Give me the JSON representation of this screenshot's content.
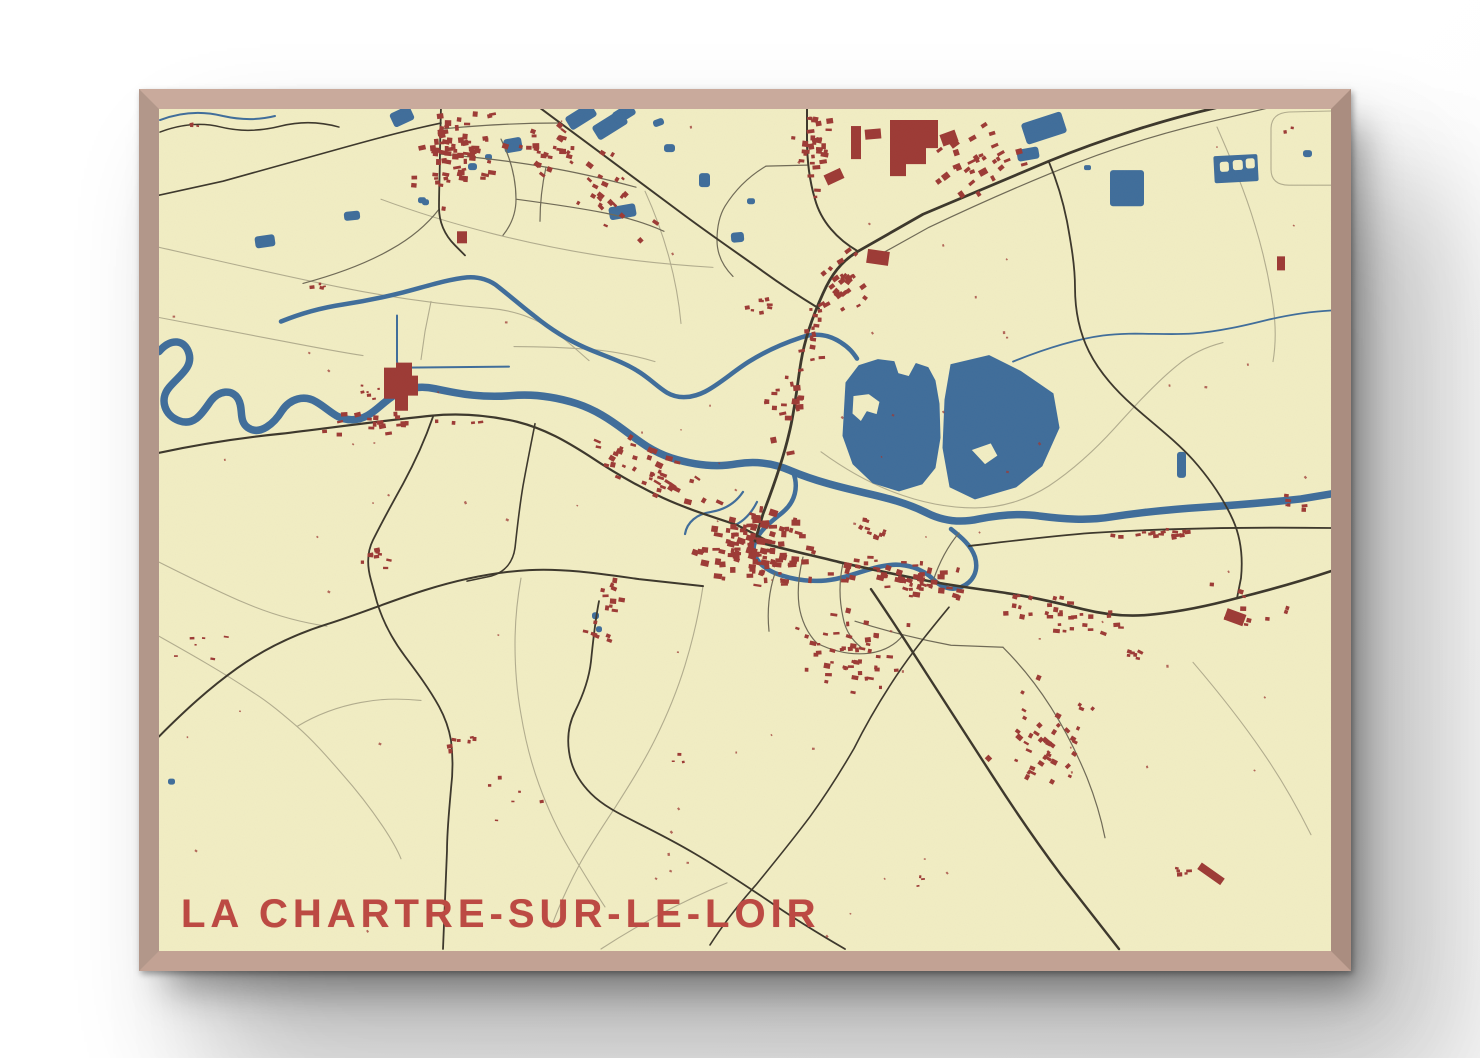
{
  "poster": {
    "title": "LA CHARTRE-SUR-LE-LOIR",
    "type_label": "framed-map-poster"
  },
  "colors": {
    "paper": "#f2eec5",
    "water": "#3f6d9c",
    "water_town": "#4a78a8",
    "building": "#9d3a36",
    "road_major": "#3c372c",
    "road_minor": "#6f6a57",
    "field_line": "#b2ad8f",
    "title_red": "#bc4a43",
    "frame_wood": "#b9998b",
    "wall": "#ffffff"
  },
  "map": {
    "lakes": [
      "M845,383 L858,366 L877,360 L893,362 L897,374 L908,377 L915,364 L927,368 L934,381 L938,404 L939,438 L934,468 L921,484 L898,491 L872,483 L852,464 L842,436 Z M852,396 L868,394 L879,402 L876,415 L866,412 L860,422 L851,414 Z",
      "M950,365 L988,356 L1020,372 L1052,394 L1058,428 L1041,466 L1015,487 L974,499 L949,487 L942,448 L944,400 Z M970,450 L990,443 L997,456 L984,465 Z"
    ],
    "rivers": [
      {
        "w": 7.5,
        "d": "M158,352 C170,338 184,340 188,354 C192,368 178,376 168,388 C158,400 164,416 178,421 C194,427 202,412 210,401 C218,391 231,389 237,399 C243,409 237,421 247,428 C259,436 273,424 281,411 C289,399 303,395 315,402 C329,410 335,420 351,420 C369,420 378,405 394,395 C406,388 420,386 434,389 C462,395 482,398 510,396 C532,394 554,397 576,404 C594,410 608,419 624,431 C640,443 652,452 670,458 C692,465 714,468 736,464 C754,461 772,463 790,471 C814,481 838,487 864,493 C886,498 906,503 926,513 C942,521 960,523 978,519 C998,515 1018,513 1038,516 C1062,519 1086,521 1110,517 C1142,512 1174,509 1206,507 C1240,505 1272,502 1300,499 L1330,494"
      },
      {
        "w": 4.5,
        "d": "M280,322 C302,313 322,308 342,305 C362,302 382,298 402,293 C422,288 446,280 466,278 C478,277 490,281 498,288 C512,299 522,308 534,317 C550,330 566,340 584,348 C602,356 620,361 636,371 C648,378 656,387 666,393 C678,400 692,398 704,392 C718,385 732,372 748,362 C764,352 782,344 800,338 C814,333 828,335 840,343 C848,348 852,353 856,359"
      },
      {
        "w": 4.5,
        "d": "M792,472 C798,487 794,502 782,512 C770,522 757,531 753,545 C751,557 760,567 774,573 C792,580 814,583 834,579 C854,575 870,567 888,565 C906,563 922,569 932,579 C940,587 950,591 960,587 C972,582 978,571 974,557 C970,545 960,537 950,529"
      },
      {
        "w": 2,
        "d": "M396,316 L396,361 Q396,368 404,368 L508,367"
      },
      {
        "w": 2.2,
        "d": "M742,492 C734,504 722,510 710,512 C696,514 686,522 684,534"
      },
      {
        "w": 2.2,
        "d": "M756,502 C750,514 742,522 732,526"
      },
      {
        "w": 1.8,
        "d": "M1012,362 C1042,350 1072,340 1102,336 C1132,332 1162,336 1192,334 C1218,332 1244,326 1268,320 C1290,315 1310,312 1330,311"
      },
      {
        "w": 2,
        "d": "M159,121 C180,113 202,112 222,117 C240,121 258,121 274,117"
      }
    ],
    "roads_major": [
      {
        "w": 2.8,
        "d": "M1296,90 L1214,109 C1162,121 1102,140 1048,162 C1002,181 962,198 922,215 L857,252 C840,262 830,276 822,294 C812,316 804,338 800,362 C796,386 794,410 788,434 C782,460 772,488 762,514 L754,541"
      },
      {
        "w": 2,
        "d": "M527,100 C577,137 628,175 678,212 C706,233 734,252 762,272 C780,285 800,298 818,309"
      },
      {
        "w": 2.2,
        "d": "M158,453 C200,444 240,438 280,434 C330,428 380,421 430,416 C460,413 490,416 516,422 C544,429 566,442 588,456 C612,472 636,486 662,498 C686,509 712,517 736,525 L763,539"
      },
      {
        "w": 2.6,
        "d": "M754,541 C782,549 810,555 838,562 C868,569 898,575 928,581 C954,586 980,589 1006,593 C1032,597 1058,603 1082,609 C1106,615 1130,617 1154,614 C1182,611 1210,605 1236,598 C1268,590 1300,581 1330,571"
      },
      {
        "w": 2.4,
        "d": "M870,589 C890,618 908,646 926,674 C948,708 970,742 992,776 C1014,810 1036,842 1060,874 L1118,948"
      },
      {
        "w": 2,
        "d": "M158,736 C184,710 208,688 236,668 C264,648 294,634 326,624 C358,614 392,600 424,590 C456,580 492,572 528,570 C564,568 602,574 638,579 L702,586"
      },
      {
        "w": 2,
        "d": "M806,95 L806,140 C806,160 808,180 814,200 C820,222 836,240 857,252"
      },
      {
        "w": 1.8,
        "d": "M1048,163 C1056,182 1062,202 1066,222 C1070,244 1074,266 1074,288 C1074,310 1078,332 1088,352 C1098,372 1114,390 1132,406 C1152,424 1174,440 1192,460 C1208,478 1222,498 1232,520 C1240,538 1242,558 1240,578 L1236,598"
      },
      {
        "w": 1.8,
        "d": "M432,417 C424,440 414,462 402,484 C392,502 382,520 372,540 C366,552 366,566 370,580 L376,602 C382,622 392,640 404,656 C416,672 428,688 438,706 C444,717 448,728 450,740 C452,756 452,772 450,788 C448,812 446,830 446,850 L442,948"
      },
      {
        "w": 1.6,
        "d": "M534,424 C530,444 526,464 522,486 C518,510 516,530 514,548 C512,562 504,572 490,576 L466,581"
      },
      {
        "w": 1.8,
        "d": "M598,601 C594,621 592,641 590,661 C588,679 582,695 574,711 C568,723 566,737 568,751 C570,767 578,781 590,793 C602,805 618,813 634,821 C654,831 674,841 694,853 C718,867 742,883 766,899 C792,917 818,933 844,948"
      },
      {
        "w": 1.6,
        "d": "M440,124 C402,132 366,142 330,152 C294,162 258,172 222,182 L158,196"
      },
      {
        "w": 1.8,
        "d": "M440,107 L439,150 C439,170 438,190 438,208 C438,224 444,236 454,246 L464,256"
      },
      {
        "w": 1.8,
        "d": "M968,546 C1010,541 1050,536 1090,533 C1170,528 1250,527 1330,528"
      },
      {
        "w": 1.6,
        "d": "M948,607 C929,630 911,652 895,676 C879,700 865,724 853,748 C839,772 825,794 809,816 C791,840 773,862 755,884 C739,902 723,922 709,944"
      },
      {
        "w": 1.5,
        "d": "M159,133 C180,125 200,123 220,128 C240,133 260,132 280,127 C300,122 320,123 338,128"
      }
    ],
    "roads_minor": [
      {
        "d": "M1284,105 L1212,122 C1152,136 1098,154 1050,174 C1006,192 966,210 928,228 L874,258"
      },
      {
        "d": "M765,167 L806,166"
      },
      {
        "d": "M765,167 C748,177 734,191 724,207 C718,217 716,229 716,241 C716,255 722,267 732,277"
      },
      {
        "d": "M440,130 C480,126 520,124 558,124"
      },
      {
        "d": "M440,155 C475,158 510,162 545,168 C575,173 605,180 635,188"
      },
      {
        "d": "M500,140 C510,160 515,180 515,200 C515,214 510,226 502,236"
      },
      {
        "d": "M515,200 C545,204 575,208 605,214 C625,218 645,224 663,232"
      },
      {
        "d": "M545,168 C541,186 539,204 539,222"
      },
      {
        "d": "M438,210 C424,228 408,240 390,250 C362,266 332,276 302,284"
      },
      {
        "d": "M802,557 C798,573 796,589 798,605 C800,619 806,633 816,643"
      },
      {
        "d": "M842,563 C838,581 838,599 842,617 C844,629 850,639 860,647"
      },
      {
        "d": "M816,643 C832,651 850,655 868,653 C882,651 894,645 902,635"
      },
      {
        "d": "M774,573 C768,591 766,611 768,631"
      },
      {
        "d": "M932,581 C938,563 946,547 958,533"
      },
      {
        "d": "M1002,647 C1020,665 1036,685 1050,707 C1064,729 1076,753 1086,777 C1094,797 1100,817 1104,837"
      },
      {
        "d": "M854,621 C886,631 918,639 950,645 L1002,647"
      }
    ],
    "field_lines": [
      {
        "d": "M158,248 C220,262 280,276 340,288 C390,298 440,305 490,309 C512,311 530,317 546,327 C562,337 574,349 588,361"
      },
      {
        "d": "M430,302 L424,332 L420,360"
      },
      {
        "d": "M820,452 C842,468 866,482 892,492 C918,502 946,508 974,508 C1000,508 1026,500 1048,486 C1072,470 1094,450 1114,428 C1134,406 1154,384 1176,366 C1190,354 1206,347 1222,343"
      },
      {
        "d": "M1330,112 L1288,113 Q1270,114 1270,130 L1270,170 Q1270,186 1288,186 L1330,186"
      },
      {
        "d": "M1216,128 C1230,160 1244,192 1254,226 C1262,252 1268,278 1272,306 C1275,326 1275,344 1272,362"
      },
      {
        "d": "M158,562 C186,576 214,590 242,602 C270,614 298,622 326,626"
      },
      {
        "d": "M158,636 C190,654 222,672 252,692 C268,702 282,714 296,726 C312,740 326,756 340,772 C356,790 370,808 382,826 C390,838 396,848 400,858"
      },
      {
        "d": "M296,726 C316,714 338,706 360,702 C380,698 400,698 420,700"
      },
      {
        "d": "M520,578 C516,600 514,622 514,644 C514,668 516,692 520,714 C524,738 530,762 538,784 C546,806 556,828 568,848 C580,868 592,888 604,906"
      },
      {
        "d": "M702,586 C698,613 692,639 684,665 C676,691 666,715 654,739 C642,763 628,785 614,807 C602,825 590,843 580,861 C568,883 558,905 550,927"
      },
      {
        "d": "M513,347 C540,347 566,348 592,350 C614,352 634,356 654,362"
      },
      {
        "d": "M158,318 C200,326 242,334 284,342 C310,347 336,352 362,356"
      },
      {
        "d": "M600,948 C640,922 682,900 726,882"
      },
      {
        "d": "M644,192 C654,214 662,236 668,258 C674,280 678,302 680,324"
      },
      {
        "d": "M1192,662 C1216,690 1240,720 1262,752 C1280,778 1296,806 1310,834"
      },
      {
        "d": "M380,200 C450,226 530,246 610,258 C646,263 680,266 712,268"
      }
    ],
    "ponds": [
      [
        254,
        236,
        20,
        12,
        -8
      ],
      [
        343,
        212,
        16,
        9,
        -6
      ],
      [
        417,
        198,
        8,
        6,
        0
      ],
      [
        390,
        110,
        22,
        15,
        -25
      ],
      [
        565,
        110,
        30,
        15,
        -32
      ],
      [
        592,
        118,
        34,
        16,
        -32
      ],
      [
        612,
        108,
        22,
        13,
        -32
      ],
      [
        503,
        139,
        18,
        14,
        -10
      ],
      [
        484,
        155,
        7,
        6,
        0
      ],
      [
        467,
        164,
        9,
        7,
        0
      ],
      [
        421,
        200,
        7,
        6,
        0
      ],
      [
        652,
        120,
        11,
        7,
        -20
      ],
      [
        663,
        145,
        11,
        8,
        0
      ],
      [
        608,
        206,
        27,
        13,
        -10
      ],
      [
        698,
        174,
        11,
        14,
        0
      ],
      [
        746,
        199,
        8,
        6,
        0
      ],
      [
        730,
        233,
        13,
        10,
        -5
      ],
      [
        1022,
        118,
        42,
        22,
        -18
      ],
      [
        1016,
        149,
        22,
        12,
        -10
      ],
      [
        1083,
        166,
        7,
        5,
        0
      ],
      [
        1109,
        171,
        34,
        36,
        0
      ],
      [
        1302,
        151,
        9,
        7,
        0
      ],
      [
        1176,
        452,
        9,
        26,
        0
      ],
      [
        591,
        612,
        7,
        7,
        0
      ],
      [
        595,
        626,
        6,
        6,
        0
      ],
      [
        167,
        778,
        7,
        6,
        0
      ]
    ],
    "pool_complex": {
      "x": 1213,
      "y": 156,
      "w": 44,
      "h": 27,
      "r": -3,
      "holes": [
        [
          1219,
          162,
          9,
          10
        ],
        [
          1232,
          161,
          10,
          10
        ],
        [
          1245,
          160,
          9,
          10
        ]
      ]
    },
    "buildings_special_paths": [
      "M383,368 L395,368 L395,363 L411,363 L411,376 L417,376 L417,396 L407,396 L407,411 L394,411 L394,399 L383,399 Z",
      "M889,121 L937,121 L937,149 L925,149 L925,165 L905,165 L905,177 L889,177 Z"
    ],
    "buildings_special_rects": [
      [
        850,
        127,
        10,
        33,
        0
      ],
      [
        864,
        130,
        16,
        10,
        -5
      ],
      [
        866,
        251,
        22,
        14,
        8
      ],
      [
        1224,
        611,
        20,
        12,
        20
      ],
      [
        1196,
        869,
        28,
        8,
        35
      ],
      [
        824,
        172,
        18,
        11,
        -25
      ],
      [
        940,
        133,
        16,
        12,
        -20
      ],
      [
        1276,
        257,
        8,
        14,
        0
      ],
      [
        456,
        232,
        10,
        12,
        0
      ]
    ],
    "building_clusters": [
      [
        455,
        150,
        45,
        42,
        0,
        60,
        3,
        8
      ],
      [
        440,
        162,
        10,
        50,
        0,
        14,
        3,
        6
      ],
      [
        540,
        150,
        42,
        22,
        10,
        20,
        3,
        7
      ],
      [
        600,
        185,
        85,
        38,
        36,
        30,
        3,
        7
      ],
      [
        812,
        150,
        22,
        55,
        0,
        32,
        3,
        8
      ],
      [
        980,
        165,
        50,
        38,
        -28,
        30,
        3,
        9
      ],
      [
        846,
        286,
        40,
        34,
        -40,
        26,
        3,
        8
      ],
      [
        812,
        330,
        16,
        40,
        0,
        14,
        3,
        7
      ],
      [
        786,
        412,
        22,
        48,
        0,
        20,
        3,
        8
      ],
      [
        648,
        474,
        78,
        30,
        22,
        40,
        3,
        8
      ],
      [
        756,
        549,
        64,
        42,
        8,
        120,
        3,
        9
      ],
      [
        906,
        580,
        85,
        20,
        8,
        55,
        3,
        8
      ],
      [
        846,
        652,
        75,
        48,
        5,
        48,
        3,
        7
      ],
      [
        1064,
        614,
        70,
        22,
        8,
        32,
        3,
        7
      ],
      [
        1044,
        740,
        55,
        62,
        35,
        42,
        3,
        7
      ],
      [
        1254,
        612,
        55,
        25,
        10,
        10,
        3,
        6
      ],
      [
        400,
        424,
        90,
        16,
        -4,
        22,
        3,
        7
      ],
      [
        606,
        612,
        26,
        38,
        10,
        16,
        3,
        7
      ],
      [
        374,
        558,
        22,
        12,
        0,
        9,
        3,
        6
      ],
      [
        462,
        744,
        16,
        12,
        0,
        7,
        3,
        6
      ],
      [
        508,
        800,
        40,
        30,
        0,
        6,
        2,
        5
      ],
      [
        200,
        646,
        30,
        14,
        0,
        6,
        2,
        5
      ],
      [
        320,
        287,
        10,
        6,
        0,
        4,
        2,
        5
      ],
      [
        1294,
        504,
        24,
        16,
        0,
        6,
        2,
        6
      ],
      [
        1134,
        652,
        26,
        10,
        15,
        6,
        3,
        6
      ],
      [
        1180,
        872,
        22,
        12,
        0,
        5,
        3,
        6
      ],
      [
        760,
        306,
        14,
        20,
        0,
        8,
        3,
        6
      ],
      [
        370,
        390,
        16,
        14,
        0,
        6,
        2,
        5
      ],
      [
        866,
        530,
        26,
        10,
        20,
        10,
        3,
        6
      ],
      [
        190,
        128,
        14,
        5,
        0,
        3,
        2,
        4
      ],
      [
        1160,
        533,
        70,
        6,
        0,
        18,
        3,
        6
      ],
      [
        680,
        760,
        10,
        8,
        0,
        3,
        2,
        4
      ],
      [
        920,
        880,
        12,
        6,
        0,
        3,
        2,
        4
      ],
      [
        1286,
        136,
        8,
        10,
        0,
        2,
        3,
        5
      ]
    ],
    "scatter": {
      "n": 80,
      "min": 1.5,
      "max": 3,
      "x1": 170,
      "y1": 120,
      "x2": 1320,
      "y2": 940
    }
  }
}
